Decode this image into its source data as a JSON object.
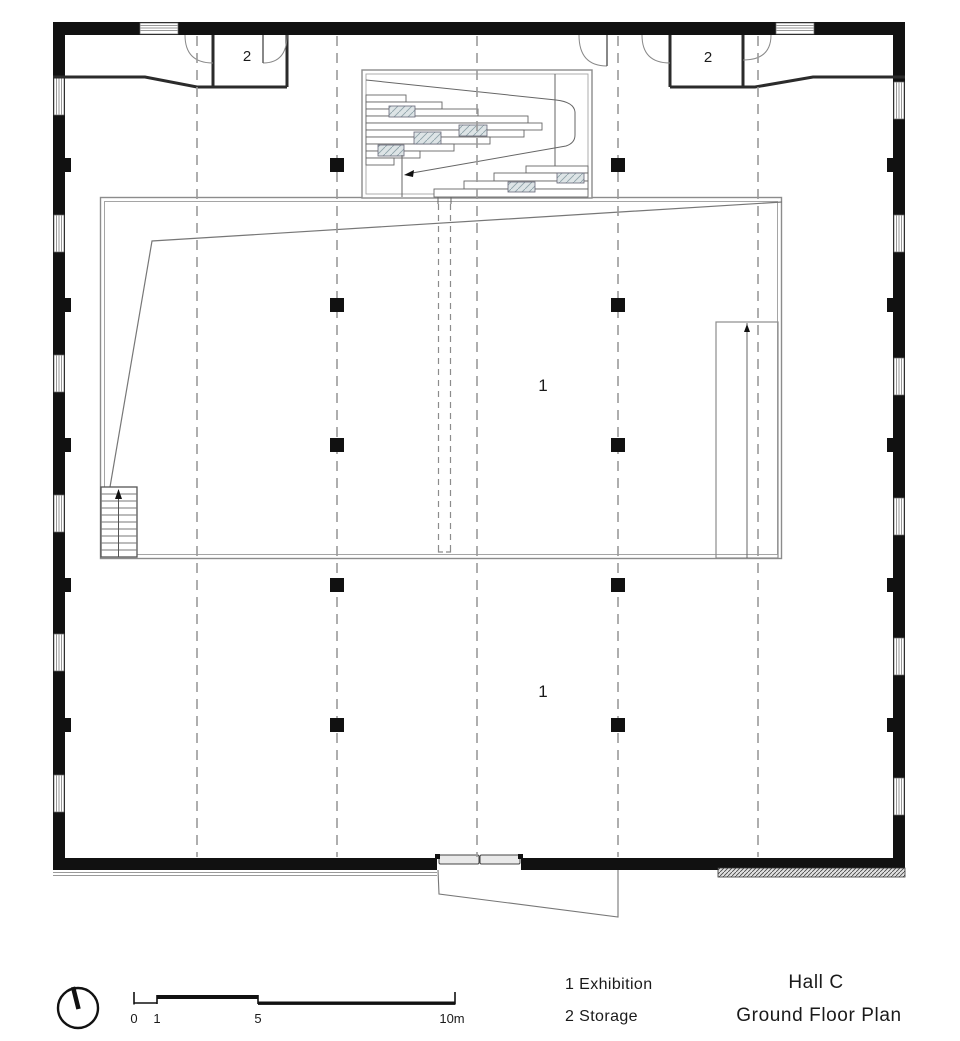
{
  "plan": {
    "room_labels": {
      "storage_left": "2",
      "storage_right": "2",
      "exhibition_upper": "1",
      "exhibition_lower": "1"
    }
  },
  "legend": {
    "items": [
      {
        "text": "1 Exhibition"
      },
      {
        "text": "2 Storage"
      }
    ]
  },
  "title_block": {
    "hall": "Hall C",
    "plan_name": "Ground Floor Plan"
  },
  "scale_bar": {
    "ticks": [
      "0",
      "1",
      "5",
      "10m"
    ]
  },
  "colors": {
    "wall": "#111111",
    "thin_line": "#777777",
    "grid_line": "#9a9a9a",
    "landing_hatch_fill": "#dde4e6",
    "background": "#ffffff"
  }
}
